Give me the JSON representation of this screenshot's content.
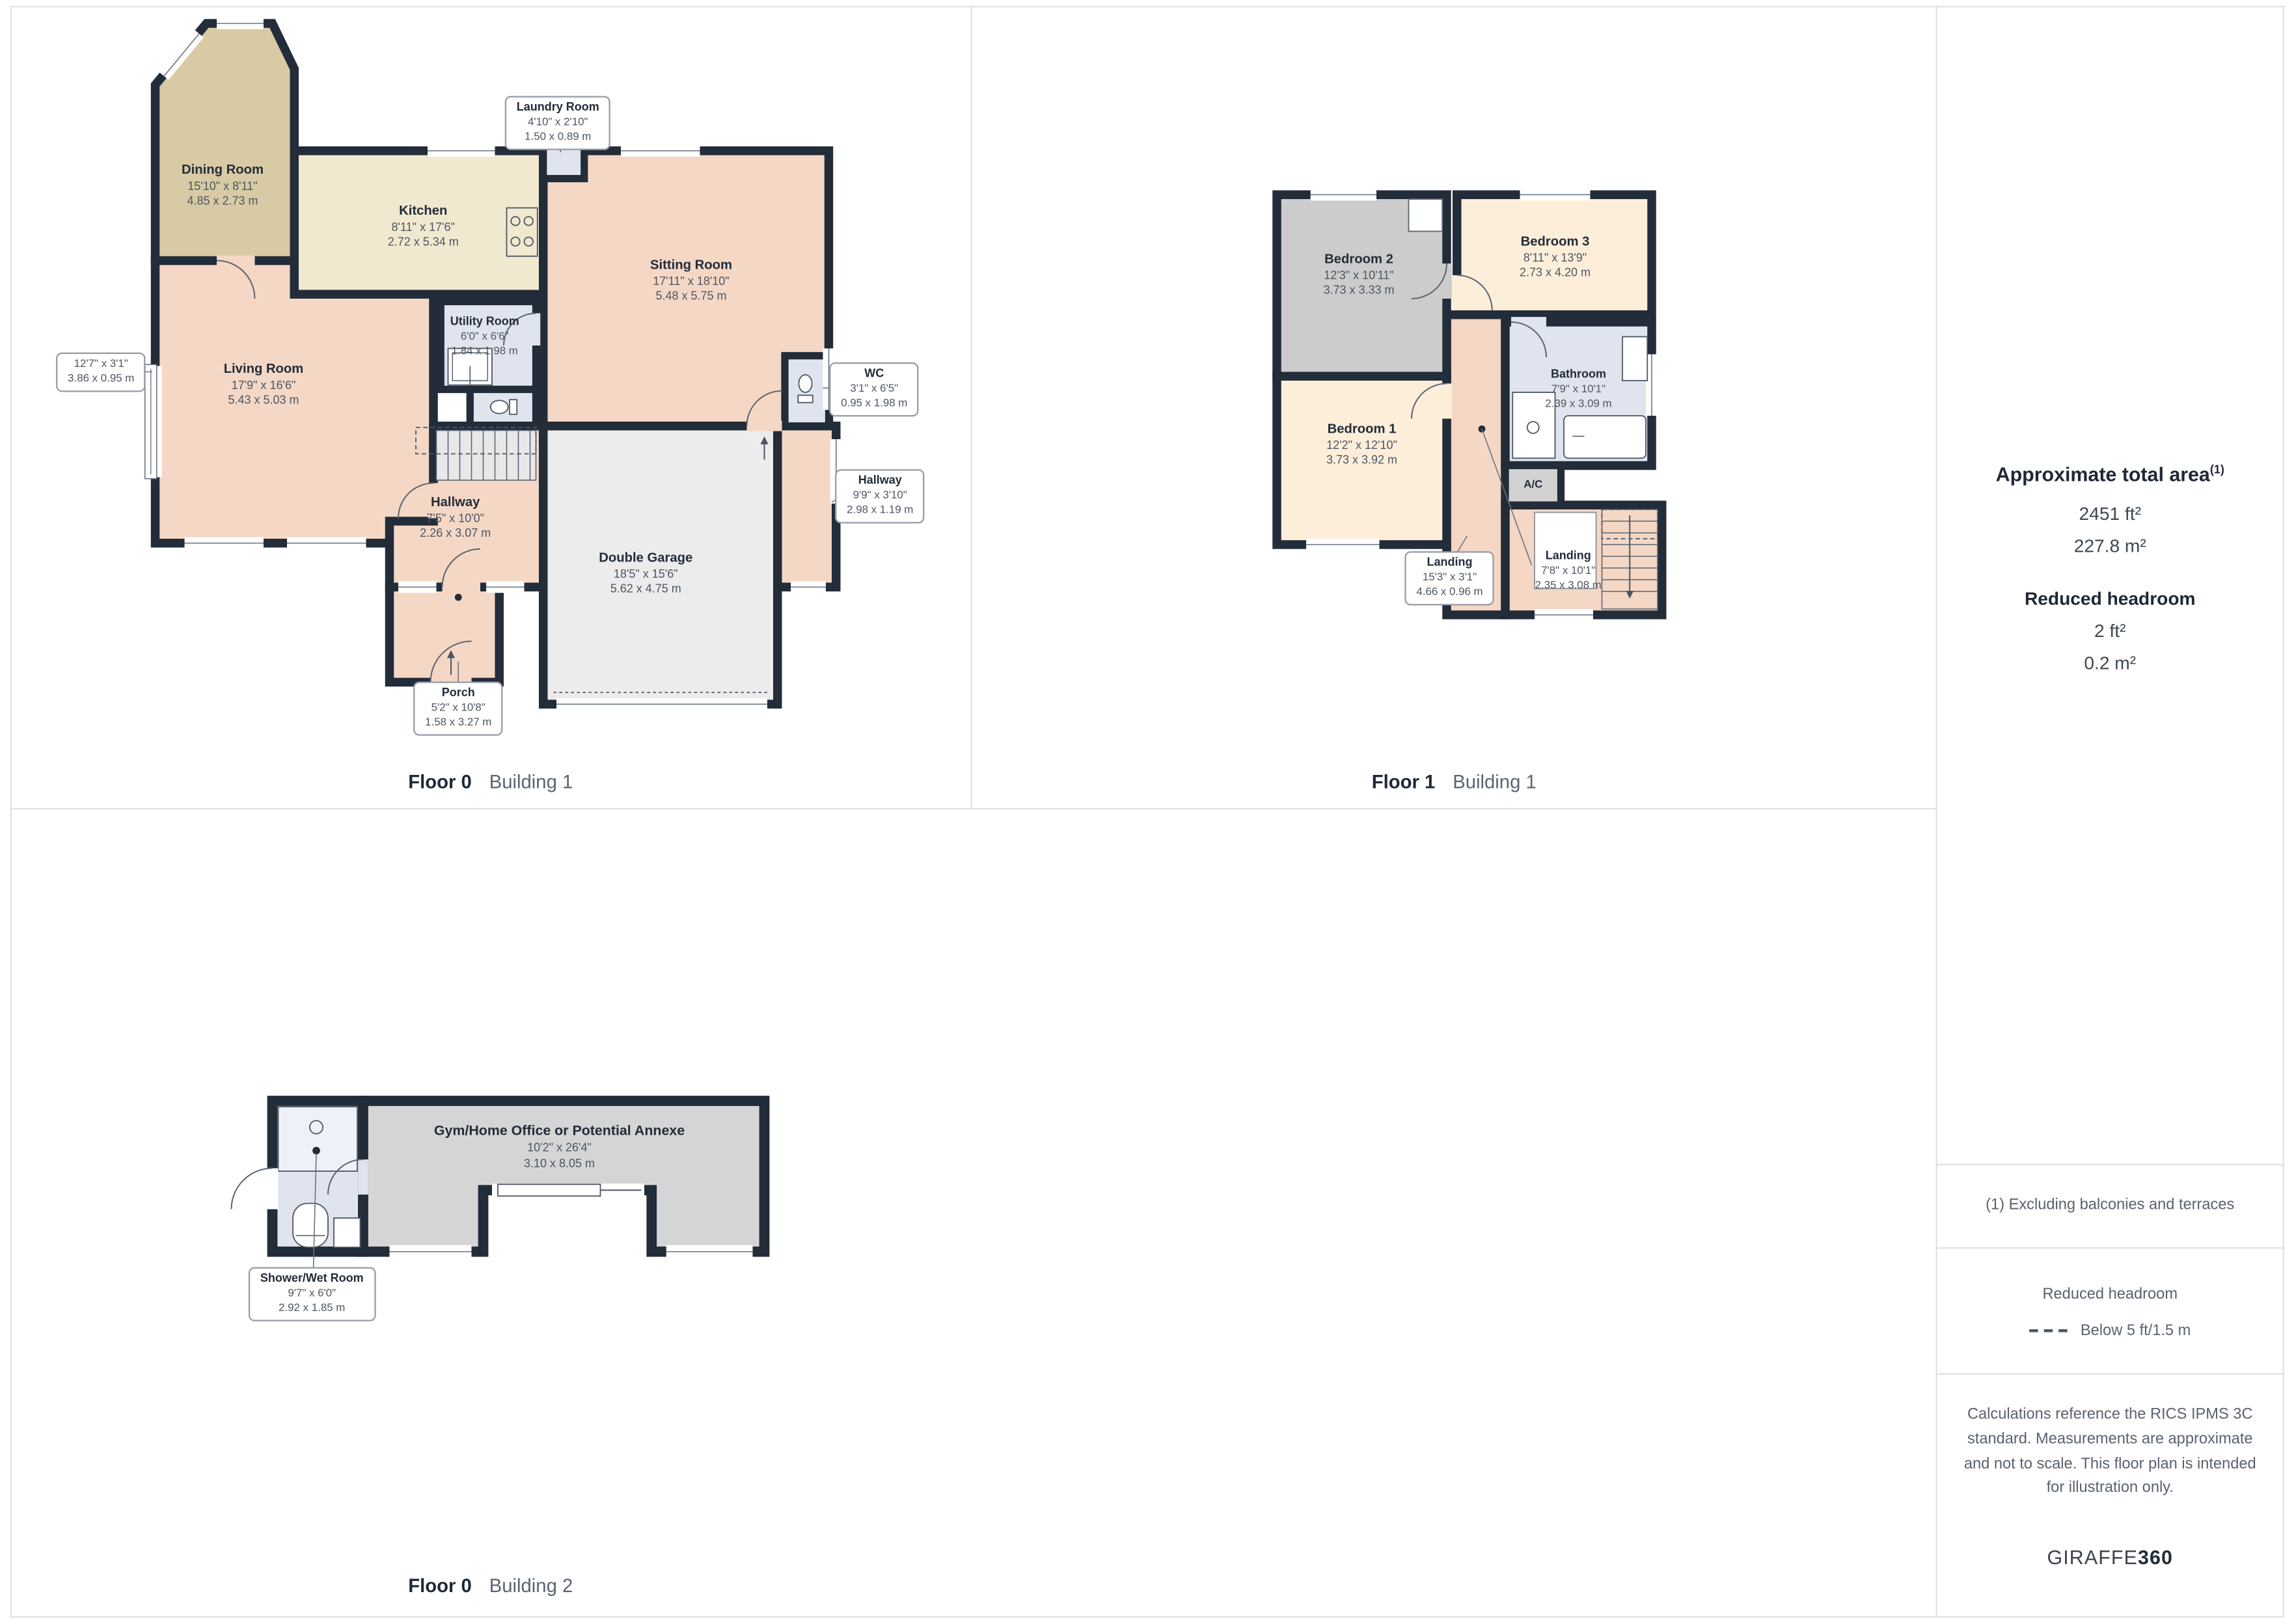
{
  "captions": {
    "f0b1": {
      "floor": "Floor 0",
      "building": "Building 1"
    },
    "f1b1": {
      "floor": "Floor 1",
      "building": "Building 1"
    },
    "f0b2": {
      "floor": "Floor 0",
      "building": "Building 2"
    }
  },
  "floor0b1": {
    "dining": {
      "name": "Dining Room",
      "ft": "15'10\" x 8'11\"",
      "m": "4.85 x 2.73 m"
    },
    "kitchen": {
      "name": "Kitchen",
      "ft": "8'11\" x 17'6\"",
      "m": "2.72 x 5.34 m"
    },
    "laundry": {
      "name": "Laundry Room",
      "ft": "4'10\" x 2'10\"",
      "m": "1.50 x 0.89 m"
    },
    "sitting": {
      "name": "Sitting Room",
      "ft": "17'11\" x 18'10\"",
      "m": "5.48 x 5.75 m"
    },
    "utility": {
      "name": "Utility Room",
      "ft": "6'0\" x 6'6\"",
      "m": "1.84 x 1.98 m"
    },
    "living": {
      "name": "Living Room",
      "ft": "17'9\" x 16'6\"",
      "m": "5.43 x 5.03 m"
    },
    "bay": {
      "ft": "12'7\" x 3'1\"",
      "m": "3.86 x 0.95 m"
    },
    "wc": {
      "name": "WC",
      "ft": "3'1\" x 6'5\"",
      "m": "0.95 x 1.98 m"
    },
    "hallway": {
      "name": "Hallway",
      "ft": "7'5\" x 10'0\"",
      "m": "2.26 x 3.07 m"
    },
    "hallway2": {
      "name": "Hallway",
      "ft": "9'9\" x 3'10\"",
      "m": "2.98 x 1.19 m"
    },
    "garage": {
      "name": "Double Garage",
      "ft": "18'5\" x 15'6\"",
      "m": "5.62 x 4.75 m"
    },
    "porch": {
      "name": "Porch",
      "ft": "5'2\" x 10'8\"",
      "m": "1.58 x 3.27 m"
    }
  },
  "floor1b1": {
    "bedroom2": {
      "name": "Bedroom 2",
      "ft": "12'3\" x 10'11\"",
      "m": "3.73 x 3.33 m"
    },
    "bedroom3": {
      "name": "Bedroom 3",
      "ft": "8'11\" x 13'9\"",
      "m": "2.73 x 4.20 m"
    },
    "bedroom1": {
      "name": "Bedroom 1",
      "ft": "12'2\" x 12'10\"",
      "m": "3.73 x 3.92 m"
    },
    "bathroom": {
      "name": "Bathroom",
      "ft": "7'9\" x 10'1\"",
      "m": "2.39 x 3.09 m"
    },
    "ac": {
      "name": "A/C"
    },
    "landing1": {
      "name": "Landing",
      "ft": "15'3\" x 3'1\"",
      "m": "4.66 x 0.96 m"
    },
    "landing2": {
      "name": "Landing",
      "ft": "7'8\" x 10'1\"",
      "m": "2.35 x 3.08 m"
    }
  },
  "floor0b2": {
    "gym": {
      "name": "Gym/Home Office or Potential Annexe",
      "ft": "10'2\" x 26'4\"",
      "m": "3.10 x 8.05 m"
    },
    "shower": {
      "name": "Shower/Wet Room",
      "ft": "9'7\" x 6'0\"",
      "m": "2.92 x 1.85 m"
    }
  },
  "sidebar": {
    "area_title": "Approximate total area",
    "area_sup": "(1)",
    "area_ft": "2451 ft²",
    "area_m": "227.8 m²",
    "rh_title": "Reduced headroom",
    "rh_ft": "2 ft²",
    "rh_m": "0.2 m²",
    "footnote": "(1) Excluding balconies and terraces",
    "legend_title": "Reduced headroom",
    "legend_item": "Below 5 ft/1.5 m",
    "disclaimer": "Calculations reference the RICS IPMS 3C standard. Measurements are approximate and not to scale. This floor plan is intended for illustration only.",
    "logo_a": "GIRAFFE",
    "logo_b": "360"
  },
  "colors": {
    "wall": "#232c39",
    "salmon_room": "#f4d7c5",
    "tan_room": "#d8caa4",
    "cream_room": "#f1e8d0",
    "wet_room": "#e0e4ef",
    "garage_room": "#ececec",
    "gray_room": "#cccccc",
    "bedroom_cream": "#fdeeda",
    "gym_room": "#d5d5d5",
    "divider": "#dfe1e4"
  }
}
